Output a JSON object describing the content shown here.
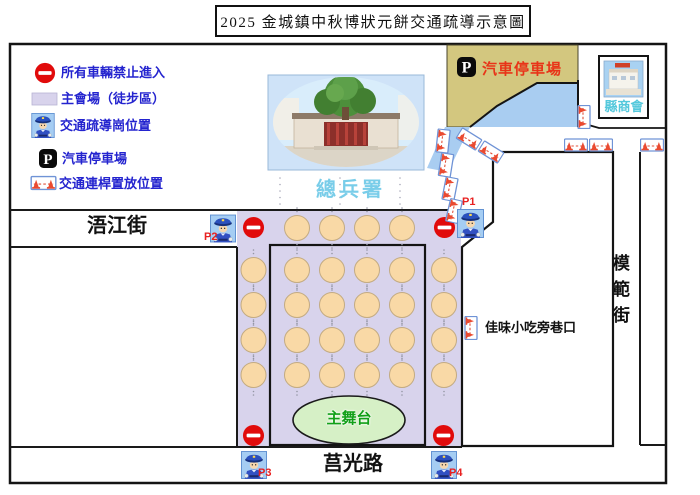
{
  "title": "2025 金城鎮中秋博狀元餅交通疏導示意圖",
  "legend": {
    "no_entry": "所有車輛禁止進入",
    "venue": "主會場（徒步區）",
    "police": "交通疏導崗位置",
    "parking": "汽車停車場",
    "barrier": "交通連桿置放位置"
  },
  "labels": {
    "temple": "總兵署",
    "chamber": "縣商會",
    "parking_lot": "汽車停車場",
    "stage": "主舞台",
    "alley": "佳味小吃旁巷口",
    "street_west": "浯江街",
    "street_south": "莒光路",
    "street_east": "模範街"
  },
  "posts": {
    "p1": "P1",
    "p2": "P2",
    "p3": "P3",
    "p4": "P4"
  },
  "icons": {
    "parking_glyph": "P"
  },
  "colors": {
    "venue_fill": "#d8d3ec",
    "table_circle": "#f9d9a6",
    "parking_area": "#d3c77f",
    "water": "#a9cdf1",
    "legend_text": "#2424cf",
    "no_entry_red": "#e10b0b",
    "stage_fill": "#d6f0c6",
    "stage_text": "#12a018",
    "temple_label": "#79cde9",
    "chamber_label": "#54c8dc",
    "parking_label": "#e83418",
    "post_label": "#e82020"
  }
}
